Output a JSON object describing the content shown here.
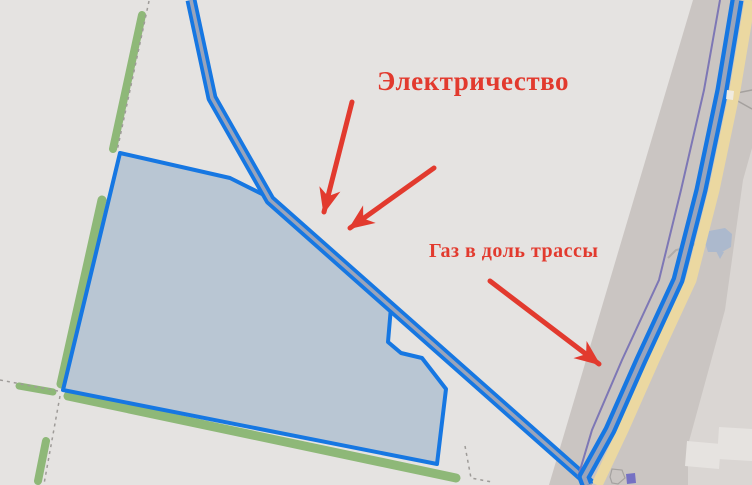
{
  "annotations": {
    "color": "#e23a2e",
    "electricity": {
      "label": "Электричество",
      "x": 377,
      "y": 66,
      "font_size": 27
    },
    "gas": {
      "label": "Газ в доль трассы",
      "x": 429,
      "y": 240,
      "font_size": 20
    },
    "arrows": [
      {
        "name": "electricity-arrow-left",
        "x1": 352,
        "y1": 102,
        "x2": 324,
        "y2": 212
      },
      {
        "name": "electricity-arrow-right",
        "x1": 434,
        "y1": 168,
        "x2": 350,
        "y2": 228
      },
      {
        "name": "gas-arrow",
        "x1": 490,
        "y1": 281,
        "x2": 599,
        "y2": 364
      }
    ]
  },
  "map": {
    "background": "#e5e3e1",
    "colors": {
      "road_blue": "#1677e2",
      "road_core": "#9aa4ba",
      "corridor_gray": "#cac5c2",
      "corridor_east": "#dad6d3",
      "light_block": "#e6e3e0",
      "yellow_band": "#ebd8a1",
      "purple_line": "#7d77b5",
      "green_strip": "#8eb878",
      "plot_fill": "#b9c6d3",
      "plot_stroke": "#1677e2",
      "dash_gray": "#9e9b98",
      "pond_blue": "#acb9cd",
      "building_indigo": "#7571c3"
    },
    "features": [
      {
        "name": "highway-corridor",
        "type": "polygon",
        "points": [
          [
            693,
            0
          ],
          [
            752,
            0
          ],
          [
            752,
            485
          ],
          [
            549,
            485
          ]
        ],
        "fill": "#cac5c2"
      },
      {
        "name": "corridor-east-zone",
        "type": "polygon",
        "points": [
          [
            752,
            148
          ],
          [
            743,
            180
          ],
          [
            725,
            310
          ],
          [
            688,
            445
          ],
          [
            688,
            485
          ],
          [
            752,
            485
          ]
        ],
        "fill": "#dad6d3"
      },
      {
        "name": "light-block",
        "type": "polygon",
        "points": [
          [
            687,
            441
          ],
          [
            721,
            444
          ],
          [
            719,
            469
          ],
          [
            685,
            466
          ]
        ],
        "fill": "#e6e3e0"
      },
      {
        "name": "light-block",
        "type": "polygon",
        "points": [
          [
            719,
            427
          ],
          [
            752,
            429
          ],
          [
            752,
            461
          ],
          [
            717,
            459
          ]
        ],
        "fill": "#e6e3e0"
      },
      {
        "name": "field-track",
        "type": "polyline",
        "points": [
          [
            727,
            95
          ],
          [
            752,
            90
          ]
        ],
        "stroke": "#a5a19e",
        "width": 1.5
      },
      {
        "name": "field-track",
        "type": "polyline",
        "points": [
          [
            727,
            95
          ],
          [
            752,
            109
          ]
        ],
        "stroke": "#a5a19e",
        "width": 1.5
      },
      {
        "name": "pond-access-path",
        "type": "polyline",
        "points": [
          [
            668,
            258
          ],
          [
            676,
            250
          ],
          [
            690,
            247
          ],
          [
            700,
            241
          ]
        ],
        "stroke": "#b0aca9",
        "width": 2
      },
      {
        "name": "pond",
        "type": "polygon",
        "points": [
          [
            704,
            240
          ],
          [
            709,
            231
          ],
          [
            725,
            228
          ],
          [
            732,
            234
          ],
          [
            731,
            247
          ],
          [
            722,
            252
          ],
          [
            708,
            252
          ]
        ],
        "fill": "#acb9cd"
      },
      {
        "name": "pond-tail",
        "type": "polygon",
        "points": [
          [
            716,
            251
          ],
          [
            724,
            252
          ],
          [
            720,
            259
          ]
        ],
        "fill": "#acb9cd"
      },
      {
        "name": "green-strip-north",
        "type": "polyline",
        "points": [
          [
            142,
            15
          ],
          [
            113,
            149
          ]
        ],
        "stroke": "#8eb878",
        "width": 8,
        "cap": "round"
      },
      {
        "name": "green-strip-west",
        "type": "polyline",
        "points": [
          [
            102,
            200
          ],
          [
            61,
            384
          ]
        ],
        "stroke": "#8eb878",
        "width": 9,
        "cap": "round"
      },
      {
        "name": "green-strip-south",
        "type": "polyline",
        "points": [
          [
            68,
            396
          ],
          [
            456,
            478
          ]
        ],
        "stroke": "#8eb878",
        "width": 9,
        "cap": "round"
      },
      {
        "name": "green-strip-left",
        "type": "polyline",
        "points": [
          [
            19,
            386
          ],
          [
            53,
            392
          ]
        ],
        "stroke": "#8eb878",
        "width": 7,
        "cap": "round"
      },
      {
        "name": "green-strip-southwest",
        "type": "polyline",
        "points": [
          [
            46,
            441
          ],
          [
            38,
            481
          ]
        ],
        "stroke": "#8eb878",
        "width": 8,
        "cap": "round"
      },
      {
        "name": "boundary-dashes",
        "type": "polyline",
        "points": [
          [
            149,
            1
          ],
          [
            117,
            151
          ]
        ],
        "stroke": "#9e9b98",
        "width": 1.5,
        "dash": "3,4"
      },
      {
        "name": "boundary-dashes",
        "type": "polyline",
        "points": [
          [
            0,
            380
          ],
          [
            58,
            391
          ]
        ],
        "stroke": "#9e9b98",
        "width": 1.5,
        "dash": "3,4"
      },
      {
        "name": "boundary-dashes",
        "type": "polyline",
        "points": [
          [
            60,
            396
          ],
          [
            44,
            484
          ]
        ],
        "stroke": "#9e9b98",
        "width": 1.5,
        "dash": "3,4"
      },
      {
        "name": "boundary-dashes",
        "type": "polyline",
        "points": [
          [
            465,
            446
          ],
          [
            471,
            478
          ],
          [
            492,
            482
          ]
        ],
        "stroke": "#9e9b98",
        "width": 1.5,
        "dash": "3,4"
      },
      {
        "name": "land-plot",
        "type": "polygon",
        "points": [
          [
            120,
            153
          ],
          [
            230,
            178
          ],
          [
            266,
            196
          ],
          [
            391,
            307
          ],
          [
            388,
            342
          ],
          [
            401,
            353
          ],
          [
            422,
            358
          ],
          [
            446,
            389
          ],
          [
            437,
            464
          ],
          [
            63,
            390
          ]
        ],
        "fill": "#b9c6d3",
        "stroke": "#1677e2",
        "width": 4,
        "join": "round"
      },
      {
        "name": "road-diagonal-casing",
        "type": "polyline",
        "points": [
          [
            191,
            0
          ],
          [
            212,
            98
          ],
          [
            270,
            200
          ],
          [
            583,
            477
          ],
          [
            591,
            485
          ]
        ],
        "stroke": "#1677e2",
        "width": 11,
        "join": "round"
      },
      {
        "name": "road-diagonal-core",
        "type": "polyline",
        "points": [
          [
            191,
            0
          ],
          [
            212,
            98
          ],
          [
            270,
            200
          ],
          [
            583,
            477
          ],
          [
            591,
            485
          ]
        ],
        "stroke": "#9aa4ba",
        "width": 3.5,
        "join": "round"
      },
      {
        "name": "utility-purple-line",
        "type": "polyline",
        "points": [
          [
            720,
            0
          ],
          [
            704,
            90
          ],
          [
            681,
            190
          ],
          [
            659,
            280
          ],
          [
            622,
            360
          ],
          [
            592,
            430
          ],
          [
            578,
            477
          ]
        ],
        "stroke": "#7d77b5",
        "width": 2
      },
      {
        "name": "highway-yellow-band",
        "type": "polyline",
        "points": [
          [
            750,
            0
          ],
          [
            735,
            90
          ],
          [
            714,
            190
          ],
          [
            691,
            280
          ],
          [
            654,
            360
          ],
          [
            623,
            430
          ],
          [
            597,
            485
          ]
        ],
        "stroke": "#ebd8a1",
        "width": 11
      },
      {
        "name": "road-highway-casing",
        "type": "polyline",
        "points": [
          [
            737,
            0
          ],
          [
            722,
            90
          ],
          [
            701,
            190
          ],
          [
            678,
            280
          ],
          [
            641,
            360
          ],
          [
            610,
            430
          ],
          [
            584,
            477
          ],
          [
            587,
            485
          ]
        ],
        "stroke": "#1677e2",
        "width": 13,
        "join": "round"
      },
      {
        "name": "road-highway-core",
        "type": "polyline",
        "points": [
          [
            737,
            0
          ],
          [
            722,
            90
          ],
          [
            701,
            190
          ],
          [
            678,
            280
          ],
          [
            641,
            360
          ],
          [
            610,
            430
          ],
          [
            584,
            477
          ],
          [
            587,
            485
          ]
        ],
        "stroke": "#9aa4ba",
        "width": 4.5,
        "join": "round"
      },
      {
        "name": "yellow-band-gap",
        "type": "polygon",
        "points": [
          [
            727,
            90
          ],
          [
            734,
            91
          ],
          [
            733,
            100
          ],
          [
            726,
            99
          ]
        ],
        "fill": "#f0ebe0"
      },
      {
        "name": "parcel-outline",
        "type": "polygon",
        "points": [
          [
            610,
            477
          ],
          [
            612,
            469
          ],
          [
            622,
            470
          ],
          [
            625,
            478
          ],
          [
            618,
            484
          ],
          [
            612,
            483
          ]
        ],
        "fill": "none",
        "stroke": "#a5a2a0",
        "width": 1.2
      },
      {
        "name": "building-indigo",
        "type": "polygon",
        "points": [
          [
            626,
            474
          ],
          [
            635,
            473
          ],
          [
            636,
            483
          ],
          [
            627,
            484
          ]
        ],
        "fill": "#7571c3"
      }
    ]
  }
}
